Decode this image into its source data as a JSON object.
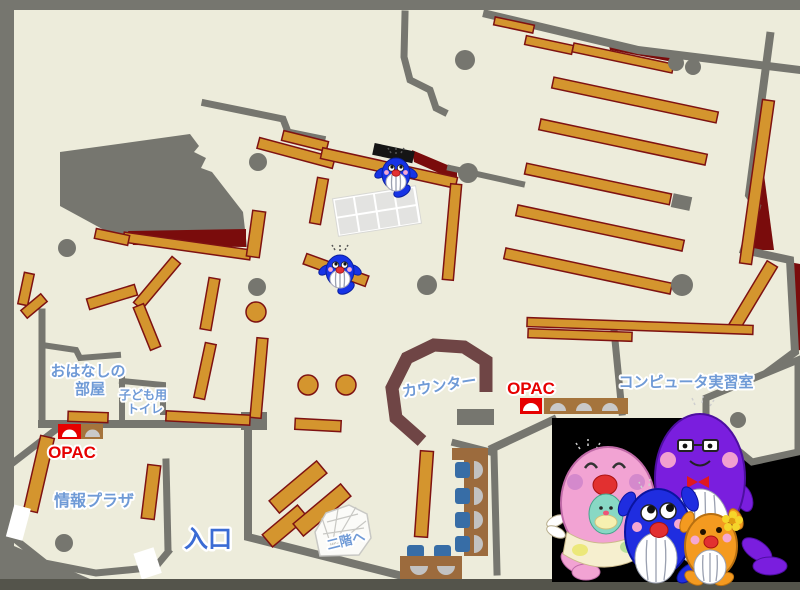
{
  "page": {
    "type": "library-floor-map"
  },
  "labels": {
    "storytelling_room": {
      "line1": "おはなしの",
      "line2": "部屋"
    },
    "kids_toilet": {
      "line1": "子ども用",
      "line2": "トイレ"
    },
    "opac_left": "OPAC",
    "opac_right": "OPAC",
    "info_plaza": "情報プラザ",
    "entrance": "入口",
    "counter": "カウンター",
    "computer_room": "コンピュータ実習室",
    "to_second_floor": "二階へ"
  },
  "colors": {
    "background_gray": "#76766f",
    "floor_cream": "#edecdb",
    "wall_gray": "#76766f",
    "shelf_tan": "#d4952e",
    "shelf_border": "#7e1212",
    "dark_red": "#7a0c0c",
    "counter_brown": "#6f4545",
    "desk_brown": "#9c6b3d",
    "chair_blue": "#376da6",
    "label_blue": "#6f9ad6",
    "entrance_blue": "#3b6cd4",
    "opac_red": "#e60000",
    "mascot_panel_black": "#000000",
    "grid_table_gray": "#e3e3e1",
    "stairs_white": "#fbfbf8"
  },
  "mascots": {
    "on_map": [
      {
        "name": "blue-whale-small-upper"
      },
      {
        "name": "blue-whale-small-lower"
      }
    ],
    "family": [
      {
        "name": "pink-whale-parent-with-baby",
        "color": "#f2a3d3"
      },
      {
        "name": "blue-whale-child",
        "color": "#1f2de0"
      },
      {
        "name": "purple-whale-parent-glasses-bowtie",
        "color": "#7a1ede"
      },
      {
        "name": "orange-whale-child-flower",
        "color": "#f49a20"
      }
    ]
  }
}
